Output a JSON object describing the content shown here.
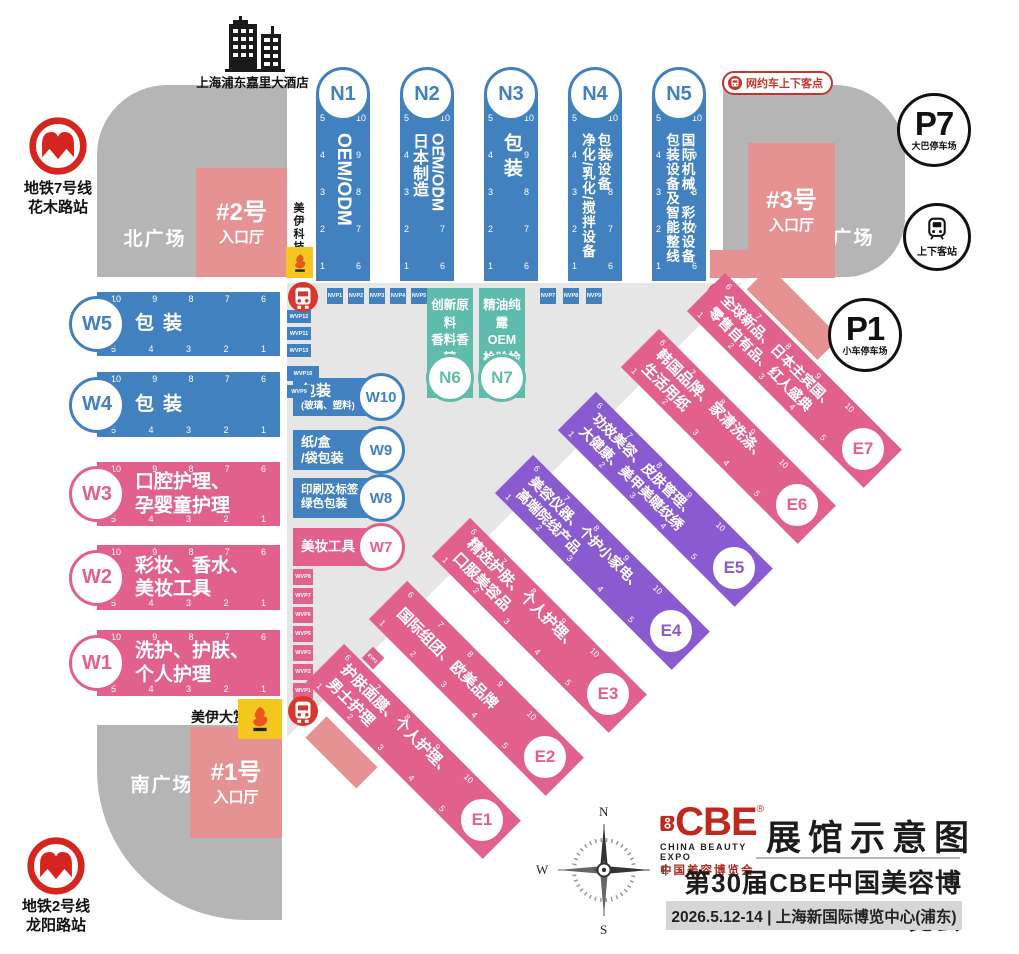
{
  "title_block": {
    "map_title": "展馆示意图",
    "expo_title": "第30届CBE中国美容博览会",
    "date_venue": "2026.5.12-14 | 上海新国际博览中心(浦东)",
    "logo": {
      "brand": "CBE",
      "reg": "®",
      "en": "CHINA BEAUTY EXPO",
      "cn": "中国美容博览会"
    }
  },
  "landmarks": {
    "hotel": "上海浦东嘉里大酒店",
    "metro_line7": [
      "地铁7号线",
      "花木路站"
    ],
    "metro_line2": [
      "地铁2号线",
      "龙阳路站"
    ],
    "parking_p7": {
      "code": "P7",
      "label": "大巴停车场"
    },
    "parking_p1": {
      "code": "P1",
      "label": "小车停车场"
    },
    "passenger_station": "上下客站",
    "rideshare_point": "网约车上下客点",
    "north_plaza": "北广场",
    "east_plaza": "东广场",
    "south_plaza": "南广场",
    "entrance_1": [
      "#1号",
      "入口厅"
    ],
    "entrance_2": [
      "#2号",
      "入口厅"
    ],
    "entrance_3": [
      "#3号",
      "入口厅"
    ],
    "meiyi_tech": "美伊科技",
    "meiyi_award": "美伊大赏"
  },
  "compass": {
    "n": "N",
    "e": "E",
    "s": "S",
    "w": "W"
  },
  "numbers": {
    "asc_low": [
      "1",
      "2",
      "3",
      "4",
      "5"
    ],
    "asc_high": [
      "6",
      "7",
      "8",
      "9",
      "10"
    ],
    "desc_low": [
      "5",
      "4",
      "3",
      "2",
      "1"
    ],
    "desc_high": [
      "10",
      "9",
      "8",
      "7",
      "6"
    ]
  },
  "vip_booths": {
    "nvp_left": [
      "NVP1",
      "NVP2",
      "NVP3",
      "NVP4",
      "NVP5"
    ],
    "nvp_right": [
      "NVP7",
      "NVP8",
      "NVP9"
    ],
    "wvp_upper": [
      "WVP12",
      "WVP11",
      "WVP13",
      "WVP10",
      "WVP9"
    ],
    "wvp_lower": [
      "WVP8",
      "WVP7",
      "WVP6",
      "WVP5",
      "WVP3",
      "WVP2",
      "WVP1"
    ],
    "evp": [
      "EVP1",
      "EVP2",
      "EVP3"
    ]
  },
  "halls": {
    "N1": {
      "code": "N1",
      "lines": [
        "OEM/ODM"
      ]
    },
    "N2": {
      "code": "N2",
      "lines": [
        "OEM/ODM",
        "日本制造"
      ]
    },
    "N3": {
      "code": "N3",
      "lines": [
        "包装"
      ]
    },
    "N4": {
      "code": "N4",
      "lines": [
        "包装设备",
        "净化/乳化/搅拌设备"
      ]
    },
    "N5": {
      "code": "N5",
      "lines": [
        "国际机械、彩妆设备",
        "包装设备及智能整线"
      ]
    },
    "N6": {
      "code": "N6",
      "lines": [
        "创新原料",
        "香料香精"
      ]
    },
    "N7": {
      "code": "N7",
      "lines": [
        "精油纯露",
        "OEM",
        "检验检测"
      ]
    },
    "W1": {
      "code": "W1",
      "lines": [
        "洗护、护肤、",
        "个人护理"
      ]
    },
    "W2": {
      "code": "W2",
      "lines": [
        "彩妆、香水、",
        "美妆工具"
      ]
    },
    "W3": {
      "code": "W3",
      "lines": [
        "口腔护理、",
        "孕婴童护理"
      ]
    },
    "W4": {
      "code": "W4",
      "lines": [
        "包装"
      ]
    },
    "W5": {
      "code": "W5",
      "lines": [
        "包装"
      ]
    },
    "W7": {
      "code": "W7",
      "lines": [
        "美妆工具"
      ]
    },
    "W8": {
      "code": "W8",
      "lines": [
        "印刷及标签、",
        "绿色包装"
      ]
    },
    "W9": {
      "code": "W9",
      "lines": [
        "纸/盒",
        "/袋包装"
      ]
    },
    "W10": {
      "code": "W10",
      "lines": [
        "包装",
        "(玻璃、塑料)"
      ]
    },
    "E1": {
      "code": "E1",
      "lines": [
        "护肤面膜、个人护理、",
        "男士护理"
      ]
    },
    "E2": {
      "code": "E2",
      "lines": [
        "国际组团、欧美品牌"
      ]
    },
    "E3": {
      "code": "E3",
      "lines": [
        "精选护肤、个人护理、",
        "口服美容品"
      ]
    },
    "E4": {
      "code": "E4",
      "lines": [
        "美容仪器、个护小家电、",
        "高端院线产品"
      ]
    },
    "E5": {
      "code": "E5",
      "lines": [
        "功效美容、皮肤管理、",
        "大健康、美甲美睫纹绣"
      ]
    },
    "E6": {
      "code": "E6",
      "lines": [
        "韩国品牌、家清洗涤、",
        "生活用纸"
      ]
    },
    "E7": {
      "code": "E7",
      "lines": [
        "全球新品、日本主宾国、",
        "零售自有品、红人盛典"
      ]
    }
  },
  "palette": {
    "hall_blue": "#4181c0",
    "hall_pink": "#e2618c",
    "hall_purple": "#8a5bd0",
    "hall_teal": "#5fbcad",
    "entrance_salmon": "#e69192",
    "plaza_gray": "#b5b5b5",
    "corridor_gray": "#e6e6e6",
    "brand_red": "#c7342b",
    "highlight_yellow": "#f3c71d"
  }
}
